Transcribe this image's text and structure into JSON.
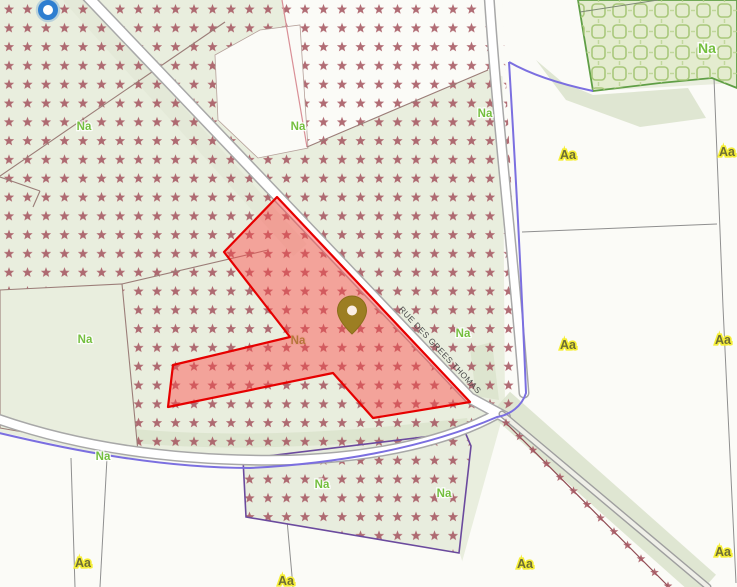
{
  "map": {
    "road_label": "RUE DES GREES THOMAS",
    "marker": {
      "type": "location-pin"
    },
    "location_dot": {
      "type": "gps-position"
    },
    "zone_labels": [
      {
        "text": "Na",
        "x": 84,
        "y": 126,
        "kind": "natural"
      },
      {
        "text": "Na",
        "x": 298,
        "y": 126,
        "kind": "natural"
      },
      {
        "text": "Na",
        "x": 485,
        "y": 113,
        "kind": "natural"
      },
      {
        "text": "Na",
        "x": 707,
        "y": 49,
        "kind": "natural-large"
      },
      {
        "text": "Na",
        "x": 85,
        "y": 339,
        "kind": "natural"
      },
      {
        "text": "Na",
        "x": 463,
        "y": 333,
        "kind": "natural"
      },
      {
        "text": "Na",
        "x": 298,
        "y": 340,
        "kind": "natural-muted"
      },
      {
        "text": "Na",
        "x": 103,
        "y": 456,
        "kind": "natural"
      },
      {
        "text": "Na",
        "x": 322,
        "y": 484,
        "kind": "natural"
      },
      {
        "text": "Na",
        "x": 444,
        "y": 493,
        "kind": "natural"
      },
      {
        "text": "Aa",
        "x": 568,
        "y": 155,
        "kind": "agricultural"
      },
      {
        "text": "Aa",
        "x": 727,
        "y": 152,
        "kind": "agricultural"
      },
      {
        "text": "Aa",
        "x": 568,
        "y": 345,
        "kind": "agricultural"
      },
      {
        "text": "Aa",
        "x": 723,
        "y": 340,
        "kind": "agricultural"
      },
      {
        "text": "Aa",
        "x": 525,
        "y": 564,
        "kind": "agricultural"
      },
      {
        "text": "Aa",
        "x": 723,
        "y": 552,
        "kind": "agricultural"
      },
      {
        "text": "Aa",
        "x": 83,
        "y": 563,
        "kind": "agricultural"
      },
      {
        "text": "Aa",
        "x": 286,
        "y": 581,
        "kind": "agricultural"
      }
    ],
    "star_line": {
      "x1": 506,
      "y1": 423,
      "x2": 668,
      "y2": 586,
      "count": 13
    },
    "colors": {
      "star_color": "#a65862",
      "na_green": "#74bf3e",
      "aa_yellow": "#f5ee35",
      "selection_red": "#e60000",
      "boundary_purple": "#6b4a9e",
      "boundary_blue": "#7b6fe0",
      "marker_gold": "#9c7e22",
      "location_blue": "#2e7ed0",
      "bg_green": "#e9eede"
    }
  }
}
